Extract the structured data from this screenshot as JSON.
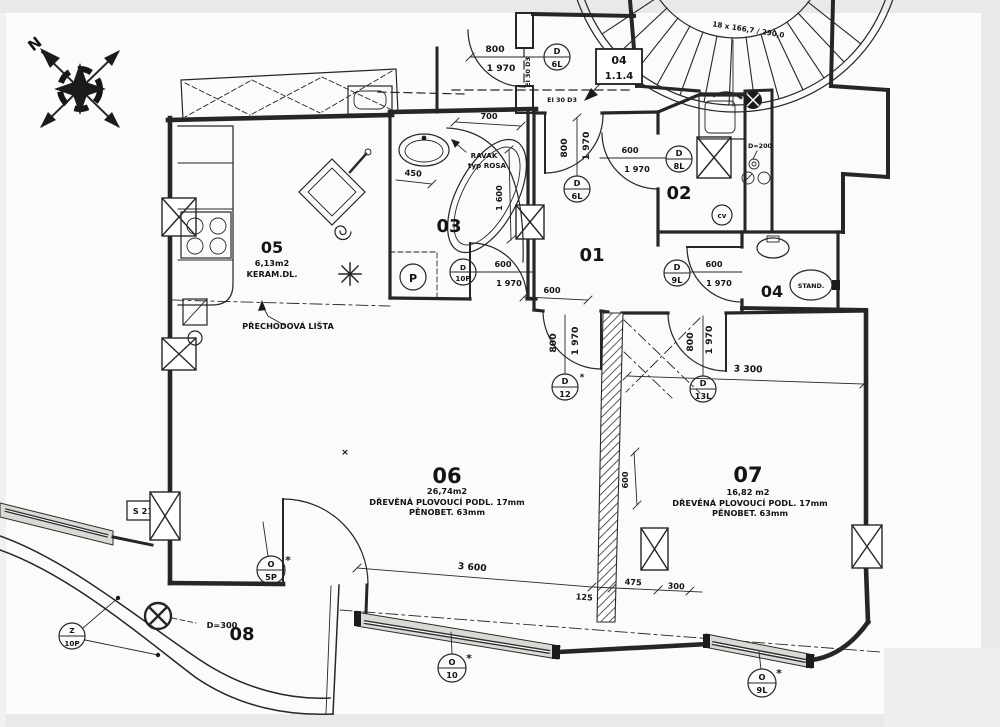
{
  "compass": {
    "north": "N"
  },
  "stairs": {
    "note": "18 x 166,7 / 290,0"
  },
  "unit_box": {
    "line1": "04",
    "line2": "1.1.4"
  },
  "fire": {
    "horizontal": "EI 30 D3",
    "vertical": "EI 30 D3"
  },
  "rooms": {
    "r01": {
      "number": "01"
    },
    "r02": {
      "number": "02"
    },
    "r03": {
      "number": "03"
    },
    "r04": {
      "number": "04"
    },
    "r05": {
      "number": "05",
      "area": "6,13m2",
      "floor": "KERAM.DL."
    },
    "r06": {
      "number": "06",
      "area": "26,74m2",
      "floor1": "DŘEVĚNÁ PLOVOUCÍ PODL. 17mm",
      "floor2": "PĚNOBET. 63mm"
    },
    "r07": {
      "number": "07",
      "area": "16,82 m2",
      "floor1": "DŘEVĚNÁ PLOVOUCÍ PODL. 17mm",
      "floor2": "PĚNOBET. 63mm"
    },
    "r08": {
      "number": "08"
    }
  },
  "doors": {
    "entrance": {
      "tag": "D",
      "num": "6L",
      "width": "800",
      "height": "1 970"
    },
    "hall": {
      "tag": "D",
      "num": "6L",
      "width": "800",
      "height": "1 970"
    },
    "d8": {
      "tag": "D",
      "num": "8L",
      "width": "600",
      "height": "1 970"
    },
    "d10": {
      "tag": "D",
      "num": "10P",
      "width": "600",
      "height": "1 970"
    },
    "d9": {
      "tag": "D",
      "num": "9L",
      "width": "600",
      "height": "1 970"
    },
    "d12": {
      "tag": "D",
      "num": "12",
      "width": "800",
      "height": "1 970",
      "mark": "*"
    },
    "d13": {
      "tag": "D",
      "num": "13L",
      "width": "800",
      "height": "1 970"
    }
  },
  "windows": {
    "o5": {
      "tag": "O",
      "num": "5P",
      "mark": "*"
    },
    "o10": {
      "tag": "O",
      "num": "10",
      "mark": "*"
    },
    "o9": {
      "tag": "O",
      "num": "9L",
      "mark": "*"
    },
    "z10": {
      "tag": "Z",
      "num": "10P"
    }
  },
  "dims": {
    "entry_width": "700",
    "basin_offset": "450",
    "tub_length": "1 600",
    "room7_width": "3 300",
    "room6_width": "3 600",
    "seg125": "125",
    "seg475": "475",
    "seg300": "300",
    "hall_door": "600",
    "wall_len": "600"
  },
  "labels": {
    "transition": "PŘECHODOVÁ LIŠTA",
    "tub_brand": "RAVAK",
    "tub_model": "typ ROSA",
    "toilet": "STAND.",
    "boiler": "cv",
    "pipe200": "D=200",
    "drain300": "D=300",
    "s21": "S 21",
    "washer": "P",
    "cross_mark": "×"
  }
}
